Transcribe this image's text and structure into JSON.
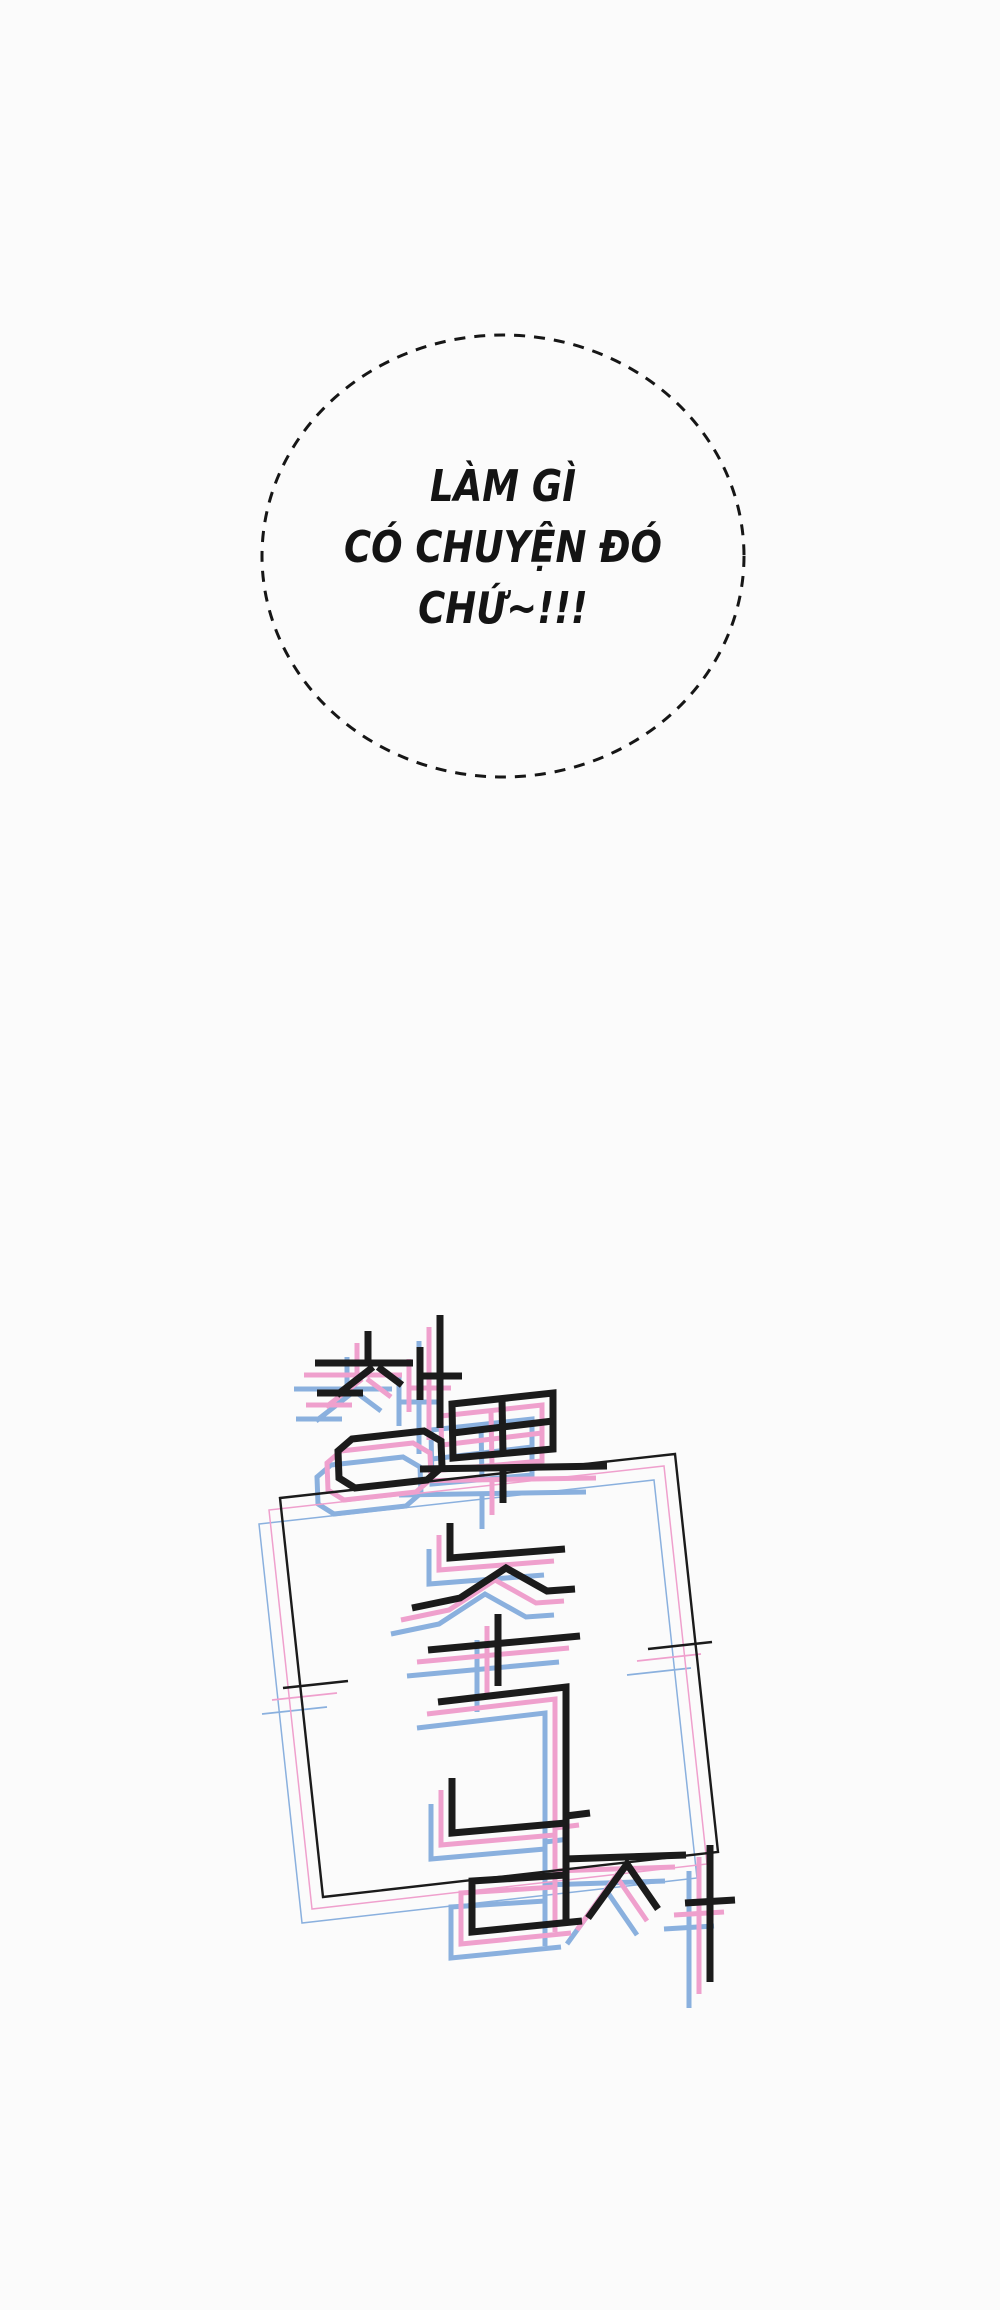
{
  "page": {
    "kind": "webtoon-comic-panel",
    "background": "#fbfbfb",
    "width": 1000,
    "height": 2310
  },
  "speech_bubble": {
    "style": "dashed-ellipse-thought-bubble",
    "border_color": "#161616",
    "text_color": "#141414",
    "lines": [
      "LÀM GÌ",
      "CÓ CHUYỆN ĐÓ",
      "CHỨ~!!!"
    ]
  },
  "logo": {
    "description": "stylized Korean logotype line-art with pink and blue offset echo copies inside a tilted rectangular frame",
    "colors": {
      "ink": "#1b1b1b",
      "pink": "#efa0cd",
      "blue": "#8ab0de"
    },
    "echo_layers": [
      {
        "name": "blue",
        "dx": -21,
        "dy": 26
      },
      {
        "name": "pink",
        "dx": -11,
        "dy": 12
      }
    ],
    "default_widths": {
      "ink": 7,
      "echo": 5
    },
    "strokes": [
      {
        "pts": [
          [
            368,
            1331
          ],
          [
            368,
            1363
          ]
        ]
      },
      {
        "pts": [
          [
            315,
            1363
          ],
          [
            413,
            1363
          ]
        ]
      },
      {
        "pts": [
          [
            373,
            1367
          ],
          [
            337,
            1395
          ]
        ]
      },
      {
        "pts": [
          [
            378,
            1367
          ],
          [
            402,
            1385
          ]
        ]
      },
      {
        "pts": [
          [
            317,
            1393
          ],
          [
            363,
            1393
          ]
        ]
      },
      {
        "pts": [
          [
            440,
            1315
          ],
          [
            440,
            1428
          ]
        ]
      },
      {
        "pts": [
          [
            420,
            1347
          ],
          [
            420,
            1400
          ]
        ]
      },
      {
        "pts": [
          [
            420,
            1376
          ],
          [
            462,
            1376
          ]
        ]
      },
      {
        "pts": [
          [
            352,
            1439
          ],
          [
            424,
            1431
          ],
          [
            441,
            1441
          ],
          [
            442,
            1467
          ],
          [
            427,
            1480
          ],
          [
            355,
            1488
          ],
          [
            339,
            1478
          ],
          [
            338,
            1451
          ]
        ],
        "closed": true
      },
      {
        "pts": [
          [
            452,
            1404
          ],
          [
            553,
            1393
          ],
          [
            553,
            1449
          ],
          [
            453,
            1458
          ]
        ],
        "closed": true
      },
      {
        "pts": [
          [
            502,
            1399
          ],
          [
            503,
            1454
          ]
        ]
      },
      {
        "pts": [
          [
            453,
            1433
          ],
          [
            553,
            1421
          ]
        ]
      },
      {
        "pts": [
          [
            420,
            1469
          ],
          [
            607,
            1466
          ]
        ]
      },
      {
        "pts": [
          [
            503,
            1469
          ],
          [
            503,
            1503
          ]
        ]
      },
      {
        "pts": [
          [
            450,
            1523
          ],
          [
            450,
            1558
          ],
          [
            565,
            1549
          ]
        ]
      },
      {
        "pts": [
          [
            412,
            1608
          ],
          [
            460,
            1598
          ],
          [
            506,
            1568
          ],
          [
            547,
            1591
          ],
          [
            575,
            1589
          ]
        ]
      },
      {
        "pts": [
          [
            428,
            1650
          ],
          [
            580,
            1636
          ]
        ]
      },
      {
        "pts": [
          [
            498,
            1614
          ],
          [
            498,
            1686
          ]
        ]
      },
      {
        "pts": [
          [
            438,
            1702
          ],
          [
            566,
            1687
          ],
          [
            566,
            1920
          ]
        ]
      },
      {
        "pts": [
          [
            452,
            1778
          ],
          [
            452,
            1833
          ],
          [
            566,
            1823
          ]
        ]
      },
      {
        "pts": [
          [
            566,
            1816
          ],
          [
            590,
            1813
          ]
        ]
      },
      {
        "pts": [
          [
            566,
            1875
          ],
          [
            472,
            1881
          ],
          [
            472,
            1932
          ],
          [
            582,
            1921
          ]
        ]
      },
      {
        "pts": [
          [
            588,
            1918
          ],
          [
            627,
            1864
          ],
          [
            658,
            1909
          ]
        ]
      },
      {
        "pts": [
          [
            565,
            1859
          ],
          [
            686,
            1855
          ]
        ]
      },
      {
        "pts": [
          [
            710,
            1845
          ],
          [
            710,
            1982
          ]
        ]
      },
      {
        "pts": [
          [
            685,
            1903
          ],
          [
            735,
            1900
          ]
        ]
      },
      {
        "pts": [
          [
            283,
            1688
          ],
          [
            348,
            1681
          ]
        ],
        "w": 2.6,
        "ew": 1.7
      },
      {
        "pts": [
          [
            648,
            1649
          ],
          [
            712,
            1642
          ]
        ],
        "w": 2.6,
        "ew": 1.7
      },
      {
        "pts": [
          [
            280,
            1498
          ],
          [
            675,
            1454
          ],
          [
            718,
            1852
          ],
          [
            323,
            1897
          ]
        ],
        "closed": true,
        "w": 2.4,
        "ew": 1.5
      }
    ]
  }
}
